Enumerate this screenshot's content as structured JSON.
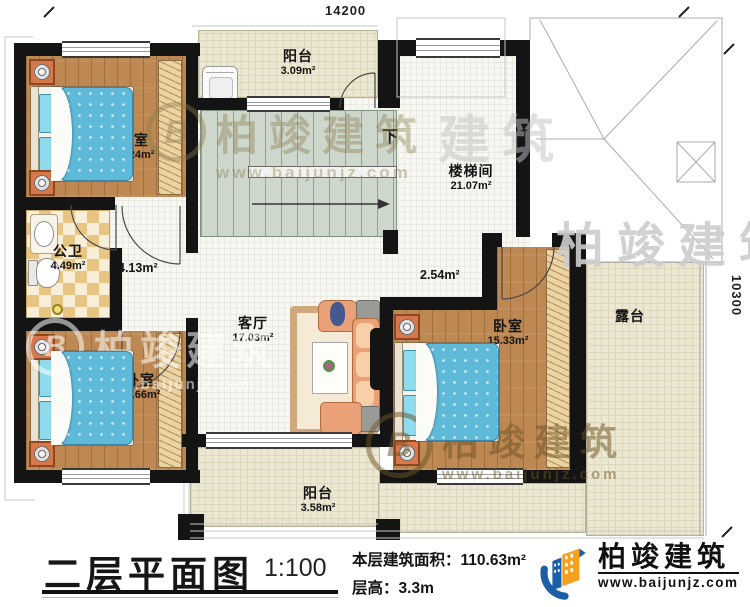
{
  "dimensions": {
    "top": "14200",
    "right": "10300"
  },
  "rooms": {
    "balcony_top": {
      "name": "阳台",
      "area": "3.09m²"
    },
    "bedroom_top_left": {
      "name": "卧室",
      "area": "10.24m²"
    },
    "bathroom": {
      "name": "公卫",
      "area": "4.49m²"
    },
    "hallway": {
      "area": "4.13m²"
    },
    "stairwell": {
      "name": "楼梯间",
      "area": "21.07m²"
    },
    "landing": {
      "area": "2.54m²"
    },
    "living_room": {
      "name": "客厅",
      "area": "17.03m²"
    },
    "bedroom_right": {
      "name": "卧室",
      "area": "15.33m²"
    },
    "bedroom_bottom_left": {
      "name": "卧室",
      "area": "10.66m²"
    },
    "balcony_bottom": {
      "name": "阳台",
      "area": "3.58m²"
    },
    "terrace": {
      "name": "露台"
    }
  },
  "stairs": {
    "direction_label": "下"
  },
  "title_block": {
    "plan_title": "二层平面图",
    "scale": "1:100",
    "floor_area_label": "本层建筑面积：",
    "floor_area_value": "110.63m²",
    "floor_height_label": "层高：",
    "floor_height_value": "3.3m"
  },
  "brand": {
    "name": "柏竣建筑",
    "website": "www.baijunjz.com"
  },
  "watermark": {
    "name": "柏竣建筑",
    "website": "www.baijunjz.com",
    "partial": "建筑",
    "logo_letter": "B"
  },
  "colors": {
    "wall": "#141414",
    "wood_floor": "#bd8851",
    "bed_blanket": "#5fb9d8",
    "tile_checker": "#e9c583",
    "outdoor_floor": "#ece7d2",
    "stair_tread": "#ccd6cb",
    "brand_blue": "#1c5fa8",
    "brand_orange": "#f5a01f"
  }
}
